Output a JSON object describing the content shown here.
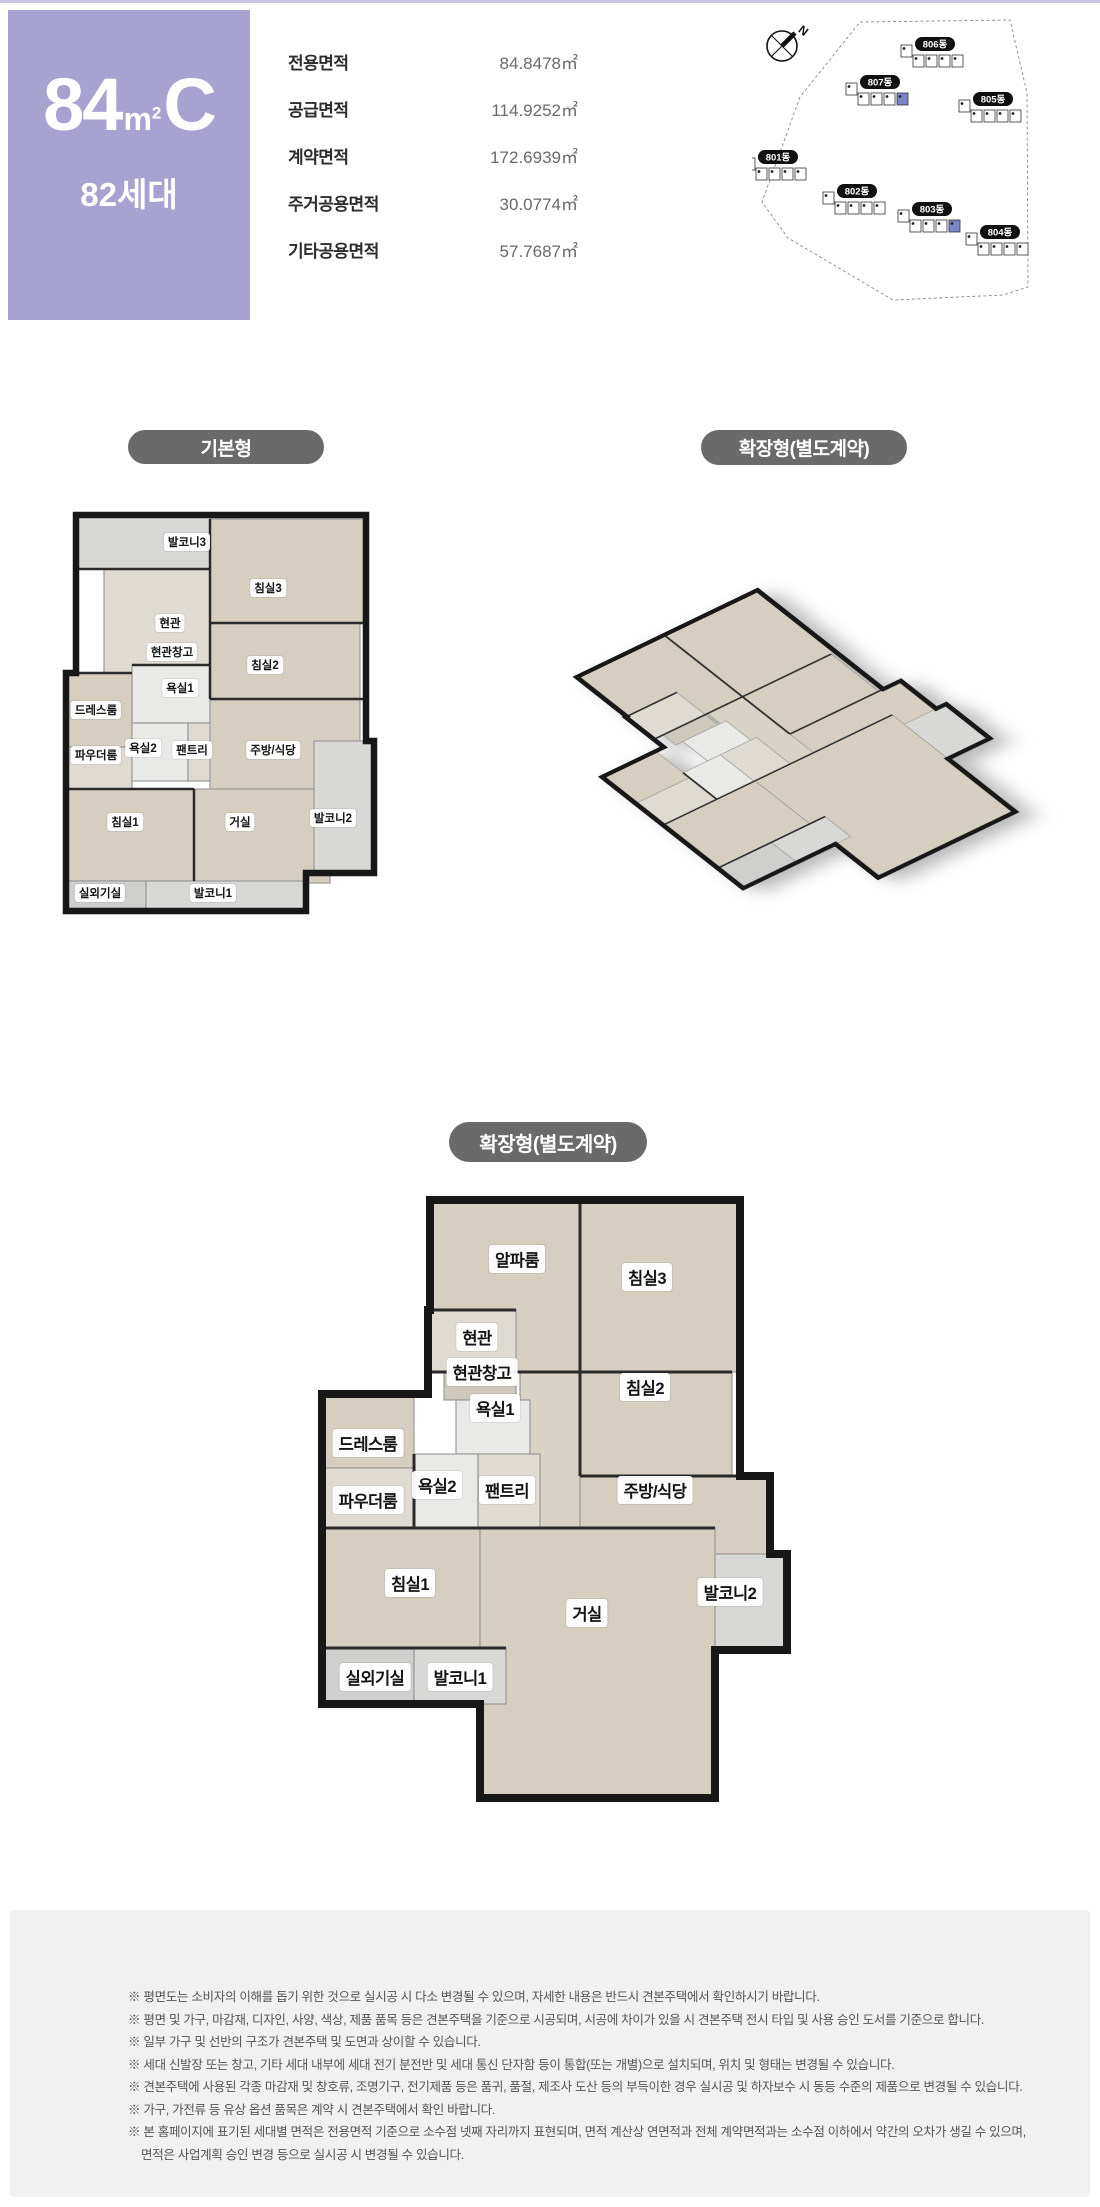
{
  "header": {
    "unit_num": "84",
    "unit_m": "m",
    "unit_sup": "2",
    "unit_suffix": "C",
    "households": "82세대",
    "box_color": "#a8a2d1",
    "areas": [
      {
        "label": "전용면적",
        "value": "84.8478㎡"
      },
      {
        "label": "공급면적",
        "value": "114.9252㎡"
      },
      {
        "label": "계약면적",
        "value": "172.6939㎡"
      },
      {
        "label": "주거공용면적",
        "value": "30.0774㎡"
      },
      {
        "label": "기타공용면적",
        "value": "57.7687㎡"
      }
    ]
  },
  "site_map": {
    "north_label": "N",
    "highlight_color": "#7e84c8",
    "buildings": [
      {
        "name": "801동",
        "x": 6,
        "y": 138,
        "highlight": false
      },
      {
        "name": "802동",
        "x": 85,
        "y": 172,
        "highlight": false
      },
      {
        "name": "803동",
        "x": 160,
        "y": 190,
        "highlight": true
      },
      {
        "name": "804동",
        "x": 228,
        "y": 213,
        "highlight": false
      },
      {
        "name": "805동",
        "x": 221,
        "y": 80,
        "highlight": false
      },
      {
        "name": "806동",
        "x": 163,
        "y": 25,
        "highlight": false
      },
      {
        "name": "807동",
        "x": 108,
        "y": 63,
        "highlight": true
      }
    ]
  },
  "sections": {
    "basic_badge": "기본형",
    "extended_badge": "확장형(별도계약)",
    "extended_badge2": "확장형(별도계약)"
  },
  "floorplans": {
    "basic": {
      "rooms": [
        {
          "label": "발코니3",
          "x": 127,
          "y": 37
        },
        {
          "label": "침실3",
          "x": 208,
          "y": 83
        },
        {
          "label": "현관",
          "x": 110,
          "y": 118
        },
        {
          "label": "현관창고",
          "x": 112,
          "y": 147
        },
        {
          "label": "침실2",
          "x": 205,
          "y": 160
        },
        {
          "label": "욕실1",
          "x": 120,
          "y": 183
        },
        {
          "label": "드레스룸",
          "x": 36,
          "y": 205
        },
        {
          "label": "욕실2",
          "x": 83,
          "y": 243
        },
        {
          "label": "팬트리",
          "x": 132,
          "y": 245
        },
        {
          "label": "파우더룸",
          "x": 36,
          "y": 250
        },
        {
          "label": "주방/식당",
          "x": 213,
          "y": 245
        },
        {
          "label": "침실1",
          "x": 65,
          "y": 317
        },
        {
          "label": "거실",
          "x": 180,
          "y": 317
        },
        {
          "label": "발코니2",
          "x": 273,
          "y": 313
        },
        {
          "label": "실외기실",
          "x": 40,
          "y": 388
        },
        {
          "label": "발코니1",
          "x": 153,
          "y": 388
        }
      ]
    },
    "extended": {
      "rooms": [
        {
          "label": "알파룸",
          "x": 207,
          "y": 67
        },
        {
          "label": "침실3",
          "x": 337,
          "y": 85
        },
        {
          "label": "현관",
          "x": 167,
          "y": 145
        },
        {
          "label": "현관창고",
          "x": 172,
          "y": 180
        },
        {
          "label": "욕실1",
          "x": 185,
          "y": 216
        },
        {
          "label": "침실2",
          "x": 335,
          "y": 195
        },
        {
          "label": "드레스룸",
          "x": 58,
          "y": 251
        },
        {
          "label": "욕실2",
          "x": 127,
          "y": 293
        },
        {
          "label": "팬트리",
          "x": 197,
          "y": 298
        },
        {
          "label": "파우더룸",
          "x": 58,
          "y": 308
        },
        {
          "label": "주방/식당",
          "x": 345,
          "y": 298
        },
        {
          "label": "침실1",
          "x": 100,
          "y": 391
        },
        {
          "label": "거실",
          "x": 277,
          "y": 421
        },
        {
          "label": "발코니2",
          "x": 420,
          "y": 400
        },
        {
          "label": "실외기실",
          "x": 65,
          "y": 485
        },
        {
          "label": "발코니1",
          "x": 150,
          "y": 485
        }
      ]
    }
  },
  "notes": [
    "※ 평면도는 소비자의 이해를 돕기 위한 것으로 실시공 시 다소 변경될 수 있으며, 자세한 내용은 반드시 견본주택에서 확인하시기 바랍니다.",
    "※ 평면 및 가구, 마감재, 디자인, 사양, 색상, 제품 품목 등은 견본주택을 기준으로 시공되며, 시공에 차이가 있을 시 견본주택 전시 타입 및 사용 승인 도서를 기준으로 합니다.",
    "※ 일부 가구 및 선반의 구조가 견본주택 및 도면과 상이할 수 있습니다.",
    "※ 세대 신발장 또는 창고, 기타 세대 내부에 세대 전기 분전반 및 세대 통신 단자함 등이 통합(또는 개별)으로 설치되며, 위치 및 형태는 변경될 수 있습니다.",
    "※ 견본주택에 사용된 각종 마감재 및 창호류, 조명기구, 전기제품 등은 품귀, 품절, 제조사 도산 등의 부득이한 경우 실시공 및 하자보수 시 동등 수준의 제품으로 변경될 수 있습니다.",
    "※ 가구, 가전류 등 유상 옵션 품목은 계약 시 견본주택에서 확인 바랍니다.",
    "※ 본 홈페이지에 표기된 세대별 면적은 전용면적 기준으로 소수점 넷째 자리까지 표현되며, 면적 계산상 연면적과 전체 계약면적과는 소수점 이하에서 약간의 오차가 생길 수 있으며,",
    "면적은 사업계획 승인 변경 등으로 실시공 시 변경될 수 있습니다."
  ]
}
